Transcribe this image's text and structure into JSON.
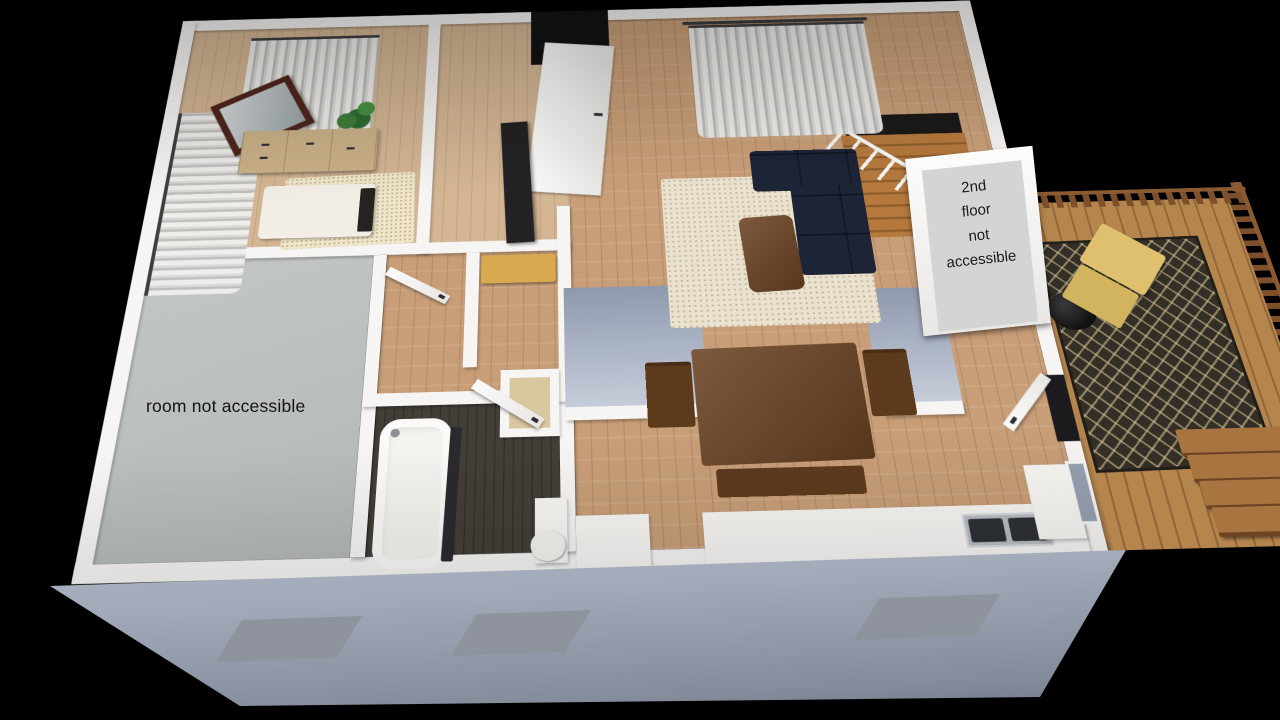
{
  "labels": {
    "room_blocked": {
      "text": "room not accessible"
    },
    "second_floor": {
      "text": "2nd floor not accessible",
      "lines": [
        "2nd",
        "floor",
        "not",
        "accessible"
      ]
    }
  },
  "colors": {
    "wall": "#f6f5f3",
    "wall_face": "#c6cdda",
    "floor_wood": "#c89e78",
    "floor_wood_light": "#d4b694",
    "floor_gray": "#b4b8b8",
    "bath_floor": "#443e38",
    "sofa": "#1d2436",
    "rug": "#eae2ce",
    "wood_furniture": "#6b4222",
    "dresser": "#cbb189",
    "deck_wood": "#b5854e",
    "deck_rail": "#7d4f2a",
    "deck_rug": "#332f26",
    "lounge": "#dec06e",
    "label_bg": "#d3d5d4",
    "label_text": "#1b1b1b",
    "window_cut": "#8d929c",
    "background": "#000000"
  }
}
